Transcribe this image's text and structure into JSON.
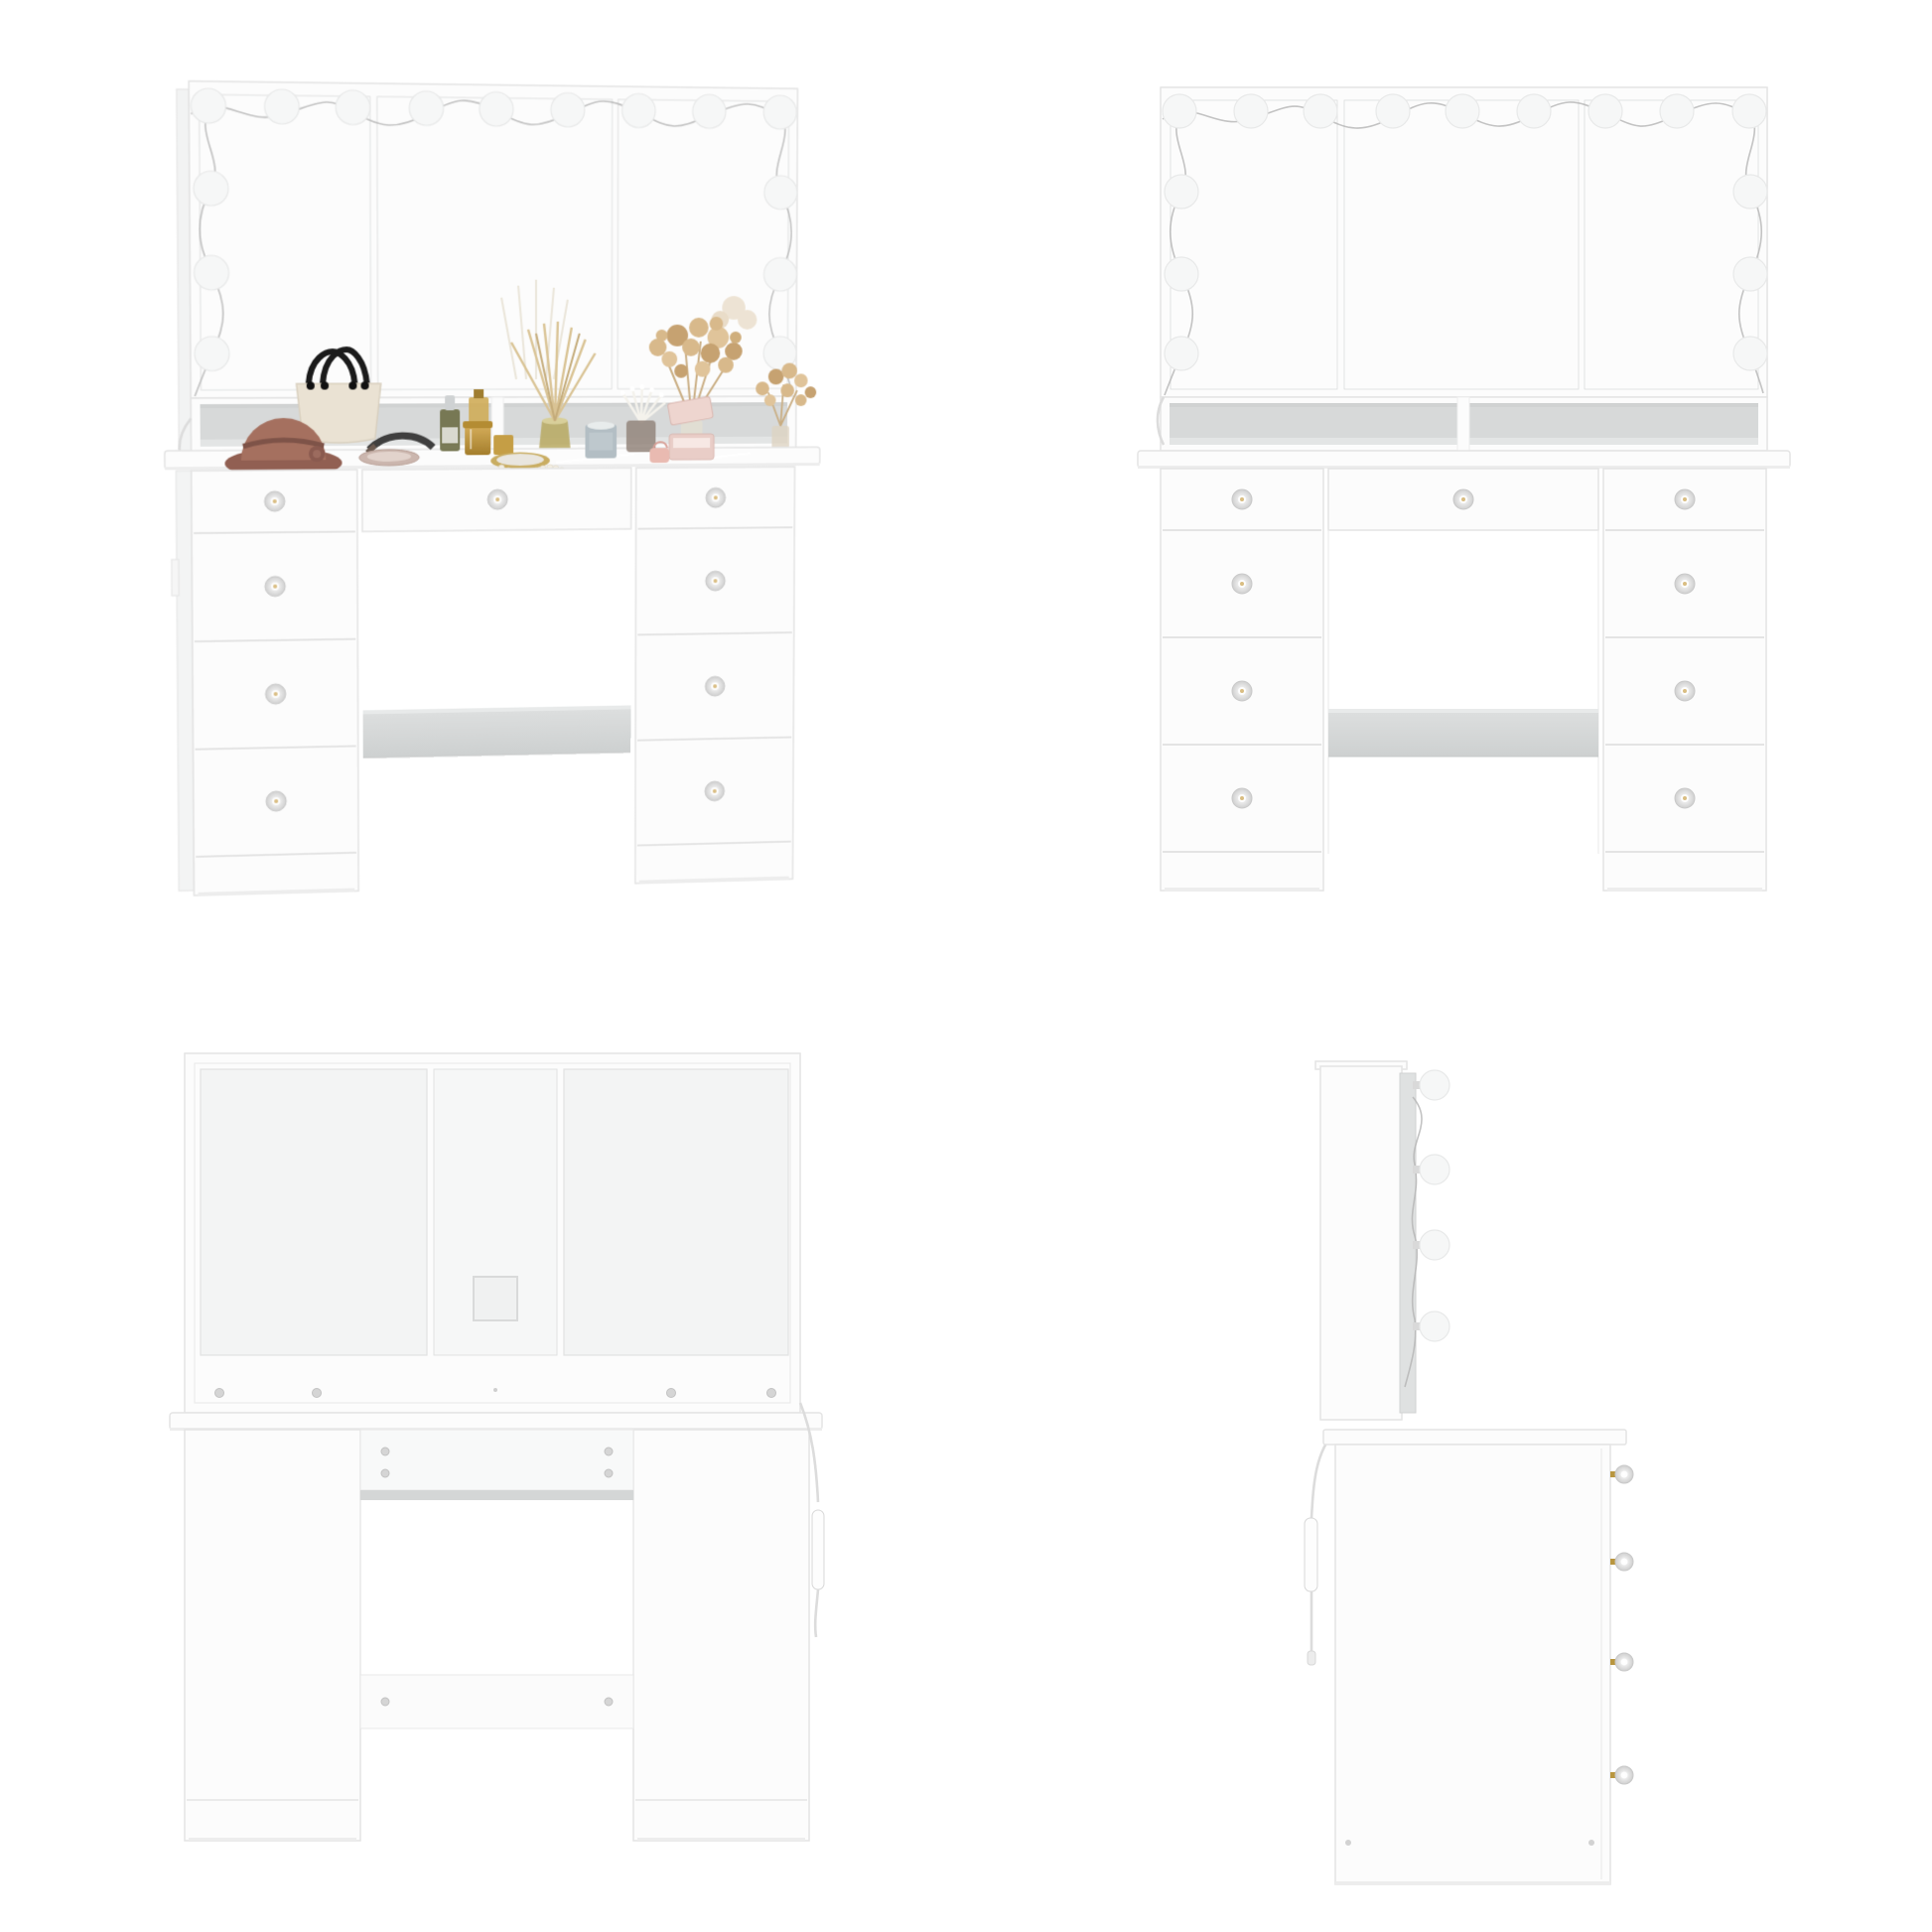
{
  "image": {
    "type": "product-photo-grid",
    "subject": "White Hollywood vanity makeup desk with lighted tri-fold mirror and nine drawers",
    "grid": "2x2 views on white background"
  },
  "colors": {
    "background": "#ffffff",
    "furniture_white": "#fcfcfc",
    "furniture_outline": "#e4e4e4",
    "panel_shade": "#f3f4f4",
    "mirror_glass_dark": "#d2d4d4",
    "mirror_glass_light": "#dddfdf",
    "cubby_back": "#d7d9d9",
    "shelf_top": "#dcdede",
    "shelf_bottom": "#cdd0d0",
    "bulb_white": "#f6f7f7",
    "bulb_outline": "#e8e9e9",
    "wire_gray": "#b4b4b4",
    "cable_gray": "#dcdcdc",
    "metal_rail": "#d4d6d6",
    "screw_gray": "#d5d5d5",
    "knob_crystal_edge": "#c8c8c8",
    "knob_gold": "#b9963f",
    "hat_brown": "#a5705f",
    "hat_brim": "#915f52",
    "bag_cream": "#eae2d3",
    "handle_black": "#1b1b1b",
    "bottle_olive": "#6f7049",
    "gold_light": "#d5ad5a",
    "gold_dark": "#a47e2c",
    "diffuser_glass": "#b7a85f",
    "reed_tan": "#d9c394",
    "flower_tan": "#d8b98b",
    "flower_tan_dark": "#c6a271",
    "candle_gray": "#b3bec4",
    "swab_brown": "#93857b",
    "jewelry_pink": "#e9cdc7",
    "jewelry_pink_light": "#f7e8e4",
    "pearl_cream": "#f3eee2"
  },
  "vanity": {
    "mirror_panels": 3,
    "light_bulbs": {
      "total": 15,
      "top_row": 9,
      "left_column": 3,
      "right_column": 3
    },
    "drawers": {
      "total": 9,
      "left_tower": 4,
      "right_tower": 4,
      "center": 1
    },
    "open_compartments_under_mirror": 2,
    "knee_shelf": true,
    "knob_style": "crystal knob with gold base",
    "tabletop": "glass top"
  },
  "views": [
    {
      "id": "front-perspective",
      "position": "top-left",
      "decor_items": [
        "brown cloche hat with flower",
        "cream handbag with black handles",
        "dark headband",
        "blush powder tray",
        "olive dropper bottle",
        "gold cosmetic jars",
        "amber perfume bottle",
        "gold hand mirror",
        "pearl necklace",
        "reed diffuser in amber vase",
        "blue-gray candle",
        "cotton swab cup",
        "pink jewelry box with open lid",
        "mini pink purse",
        "dried flower bouquet in vase",
        "small dried flower bunch"
      ]
    },
    {
      "id": "front",
      "position": "top-right",
      "light_bulbs_visible": 15
    },
    {
      "id": "back",
      "position": "bottom-left",
      "features": [
        "three back panels",
        "square cable cutout",
        "mounting rail with screws",
        "upper back panel with four screws",
        "metal drawer rail",
        "lower cross rail with two screws",
        "power cord with inline switch"
      ]
    },
    {
      "id": "side",
      "position": "bottom-right",
      "light_bulbs_visible": 4,
      "drawer_knobs_visible": 4,
      "features": [
        "mirror panel edge-on",
        "power cord with inline switch and plug",
        "two base screws"
      ]
    }
  ]
}
